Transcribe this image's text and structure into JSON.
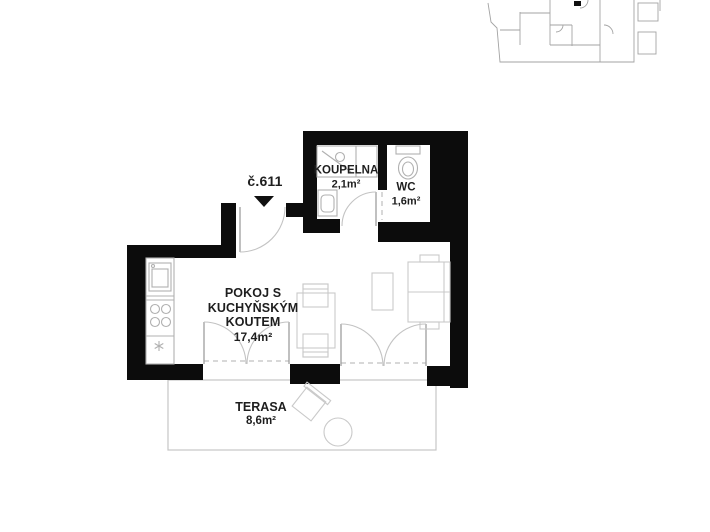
{
  "colors": {
    "background": "#ffffff",
    "wall": "#0c0c0c",
    "label-text": "#1e1e1e",
    "furniture-line": "#c9c9c9",
    "fixture-line": "#b0b0b0",
    "door-line": "#c3c3c3",
    "leaf-line": "#9e9e9e",
    "terrace-line": "#c6c6c6",
    "overview-line": "#a3a3a3"
  },
  "unit": {
    "number": "č.611"
  },
  "rooms": {
    "bathroom": {
      "name": "KOUPELNA",
      "area": "2,1m²"
    },
    "wc": {
      "name": "WC",
      "area": "1,6m²"
    },
    "main": {
      "line1": "POKOJ S",
      "line2": "KUCHYŇSKÝM",
      "line3": "KOUTEM",
      "area": "17,4m²"
    },
    "terrace": {
      "name": "TERASA",
      "area": "8,6m²"
    }
  }
}
